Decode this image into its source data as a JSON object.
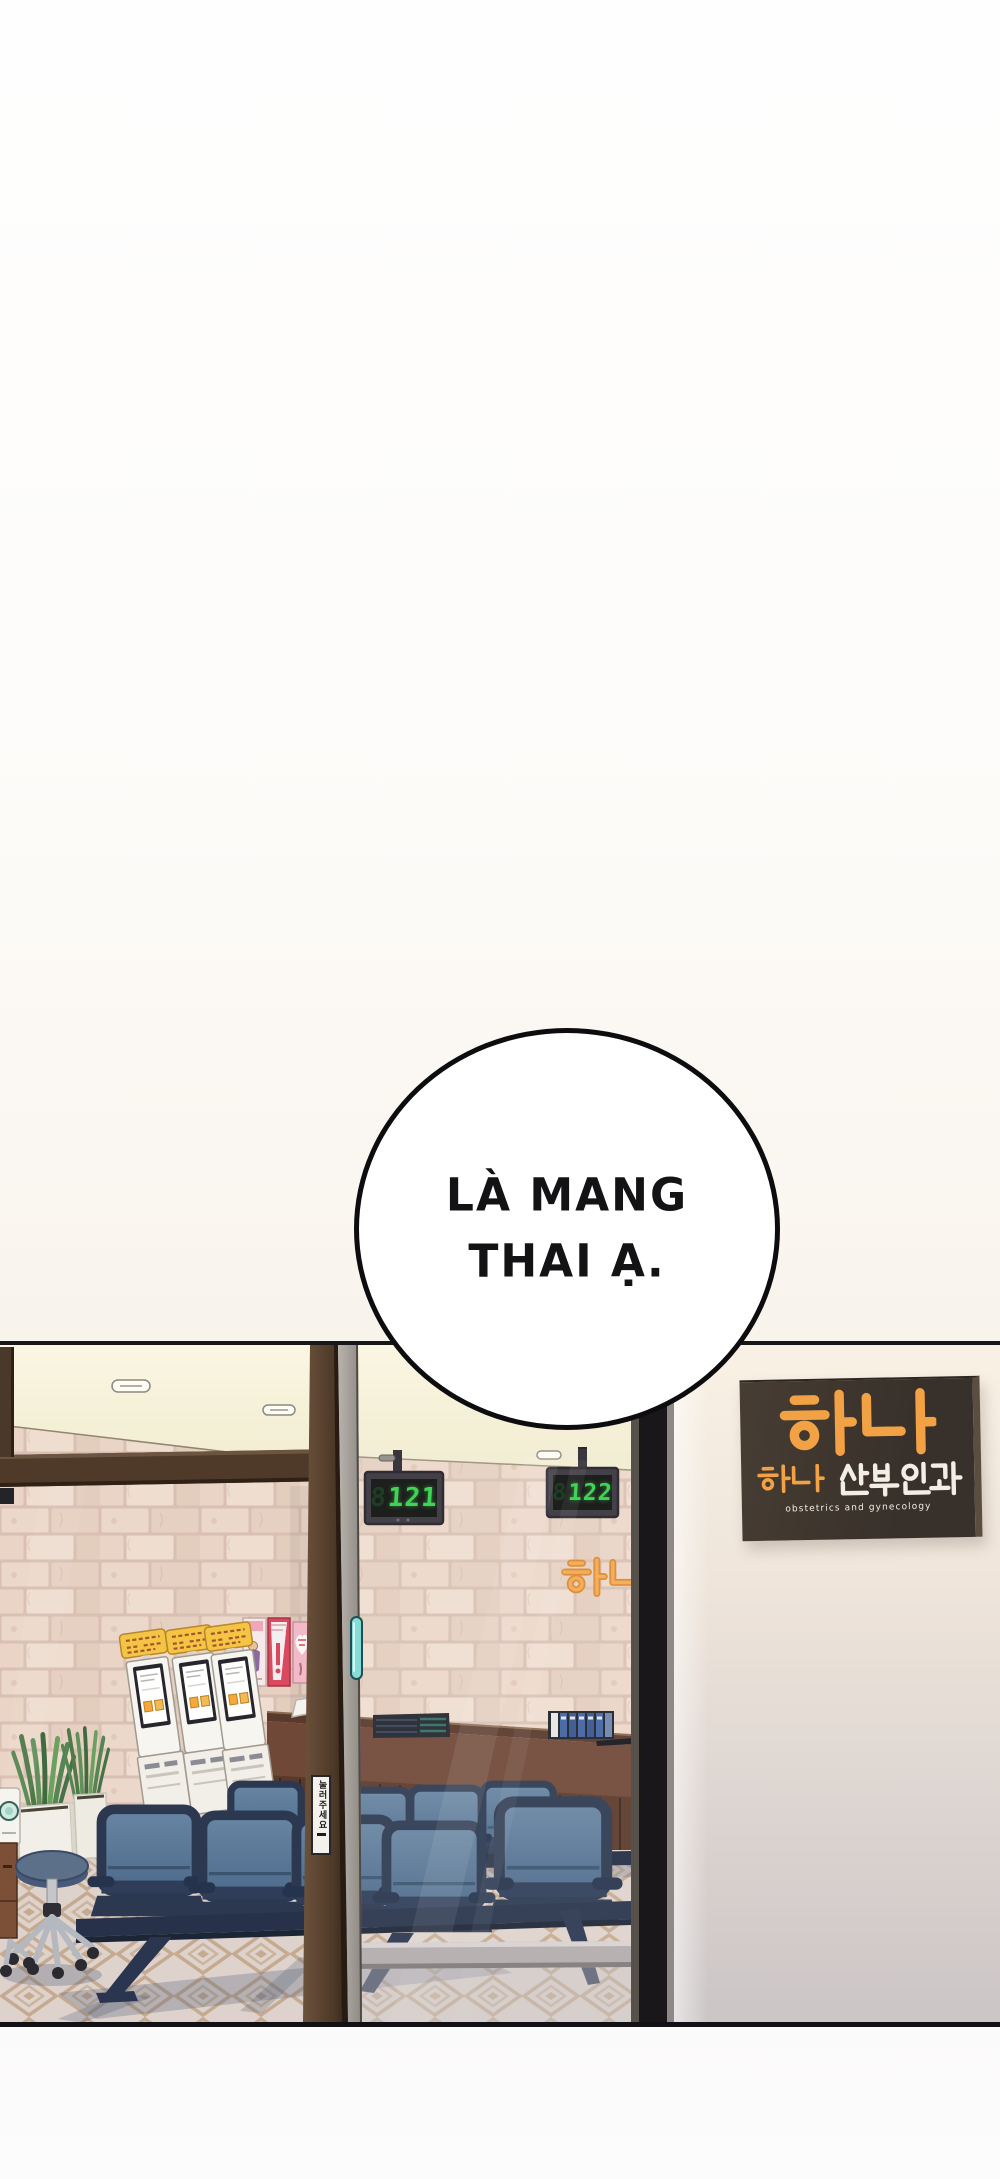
{
  "page": {
    "type": "webtoon comic panel, clinic waiting room seen through glass storefront"
  },
  "speech_bubble": {
    "line1": "LÀ MANG",
    "line2": "THAI Ạ."
  },
  "clinic": {
    "sign": {
      "brand": "하나",
      "name_orange": "하나",
      "name_white": "산부인과",
      "subtitle": "obstetrics and gynecology"
    },
    "wall_logo": "하나",
    "queue_displays": [
      {
        "ghost": "8",
        "value": "121"
      },
      {
        "ghost": "8",
        "value": "122"
      }
    ],
    "door_sign": "눌러주세요"
  },
  "colors": {
    "sign_orange": "#f2a245",
    "led_green": "#3fd455",
    "chair_navy": "#2c3850",
    "chair_blue": "#5f7f9e",
    "tile_pink": "#e7d2c6",
    "handle_teal": "#7ed7d2",
    "wood_brown": "#6f4837"
  }
}
